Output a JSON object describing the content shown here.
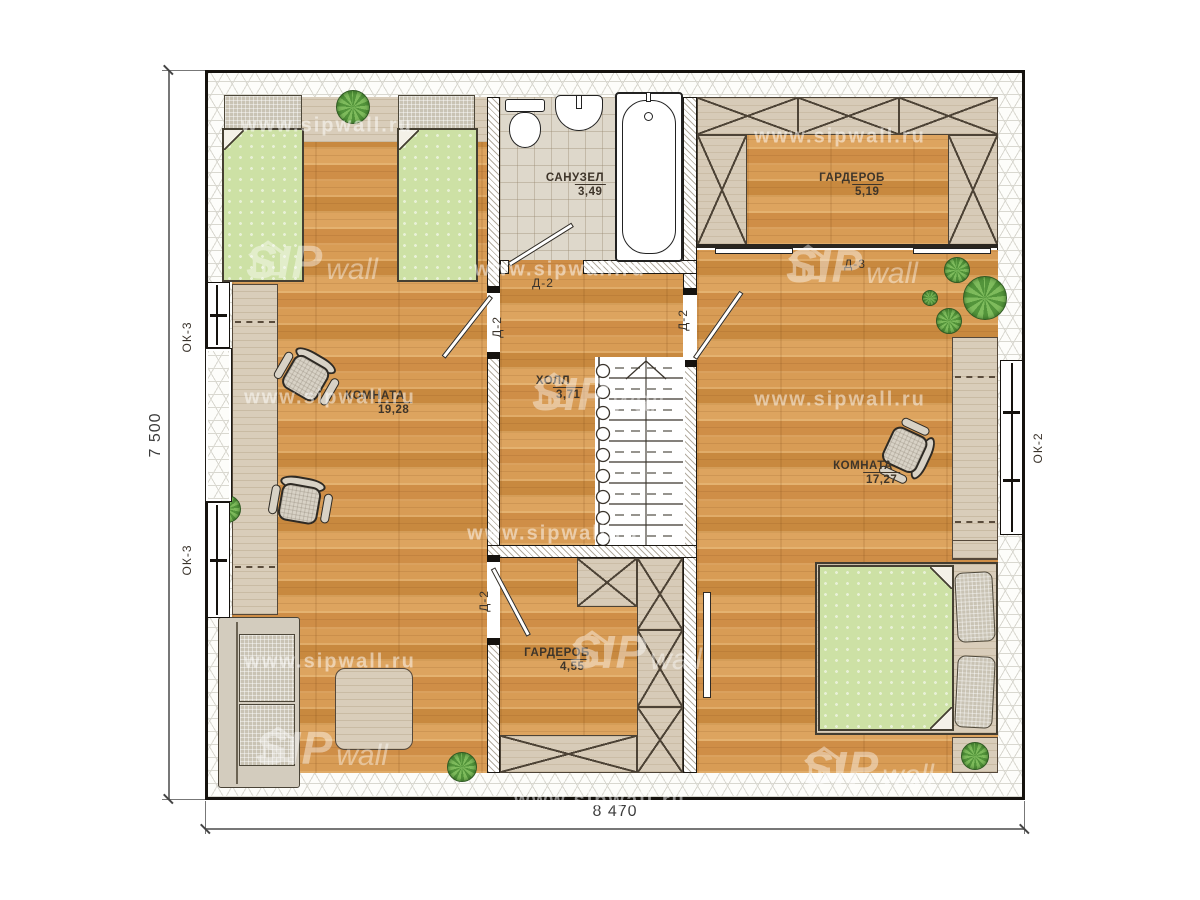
{
  "rooms": {
    "bathroom": {
      "name": "САНУЗЕЛ",
      "area": "3,49"
    },
    "wardrobe_top": {
      "name": "ГАРДЕРОБ",
      "area": "5,19"
    },
    "room_left": {
      "name": "КОМНАТА",
      "area": "19,28"
    },
    "hall": {
      "name": "ХОЛЛ",
      "area": "3,71"
    },
    "room_right": {
      "name": "КОМНАТА",
      "area": "17,27"
    },
    "wardrobe_bottom": {
      "name": "ГАРДЕРОБ",
      "area": "4,55"
    }
  },
  "doors": {
    "d2": "Д-2",
    "d3": "Д-3"
  },
  "windows": {
    "ok3": "ОК-3",
    "ok2": "ОК-2"
  },
  "dimensions": {
    "total_height_mm": "7 500",
    "total_width_mm": "8 470"
  },
  "watermark": {
    "sip": "SIP",
    "wall": "wall",
    "url": "www.sipwall.ru"
  }
}
